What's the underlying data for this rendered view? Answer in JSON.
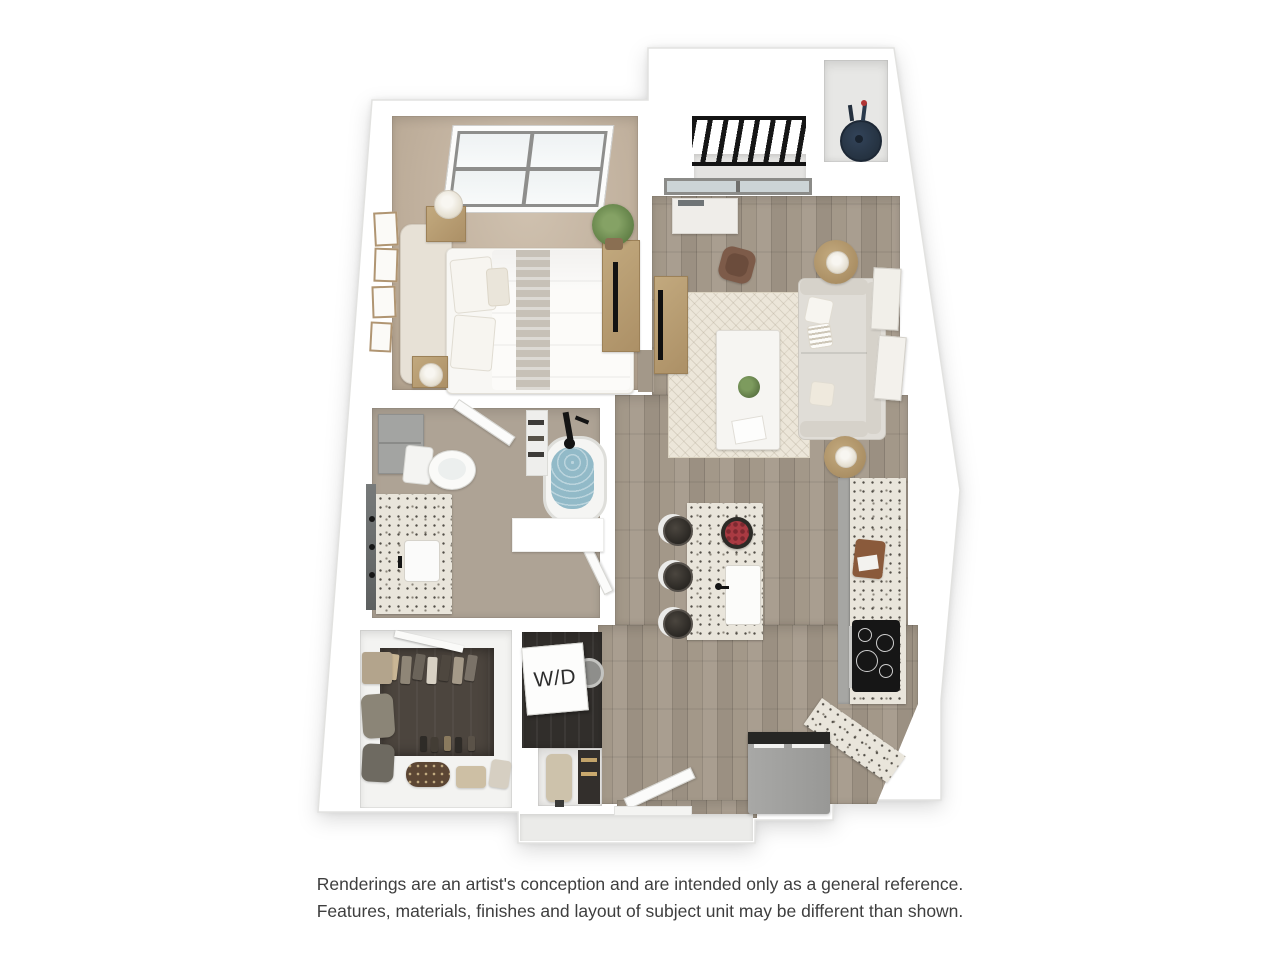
{
  "floorplan": {
    "washer_dryer_label": "W/D"
  },
  "disclaimer": {
    "line1": "Renderings are an artist's conception and are intended only as a general reference.",
    "line2": "Features, materials, finishes and layout of subject unit may be different than shown."
  },
  "colors": {
    "background": "#ffffff",
    "wall": "#ffffff",
    "wood_floor": "#9d9187",
    "bathroom_floor": "#aea395",
    "bedroom_carpet": "#c1b19e",
    "area_rug": "#ece6d9",
    "granite_counter": "#e9e5db",
    "cabinet_gray": "#a3a4a2",
    "appliance_gray": "#9e9e9c",
    "cooktop_black": "#161616",
    "tub_water": "#92bac8",
    "grill_navy": "#2c3b4e",
    "railing_black": "#141414",
    "closet_floor": "#4c453e",
    "sofa": "#e0ddd7",
    "disclaimer_text": "#3e3e3e"
  }
}
